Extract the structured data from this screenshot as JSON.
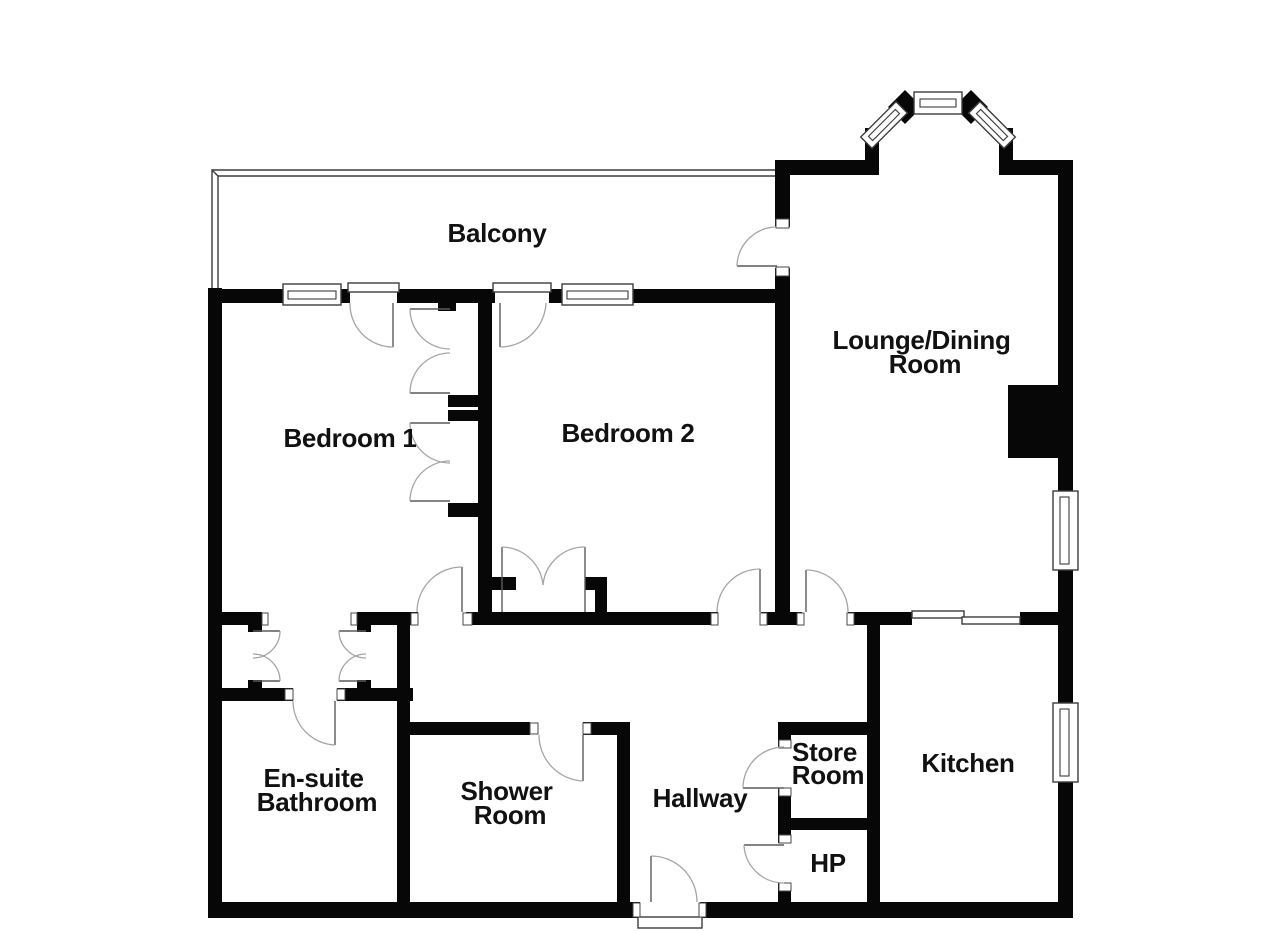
{
  "plan": {
    "type": "floor-plan",
    "colors": {
      "background": "#ffffff",
      "wall": "#070707",
      "door_swing": "#a5a5a5",
      "thin_line": "#3c3c3c",
      "label": "#111111"
    },
    "rooms": {
      "balcony": {
        "label": "Balcony"
      },
      "bedroom1": {
        "label": "Bedroom 1"
      },
      "bedroom2": {
        "label": "Bedroom 2"
      },
      "lounge": {
        "lines": [
          "Lounge/Dining",
          "Room"
        ]
      },
      "ensuite": {
        "lines": [
          "En-suite",
          "Bathroom"
        ]
      },
      "shower": {
        "lines": [
          "Shower",
          "Room"
        ]
      },
      "hallway": {
        "label": "Hallway"
      },
      "store": {
        "lines": [
          "Store",
          "Room"
        ]
      },
      "hp": {
        "label": "HP"
      },
      "kitchen": {
        "label": "Kitchen"
      }
    }
  }
}
